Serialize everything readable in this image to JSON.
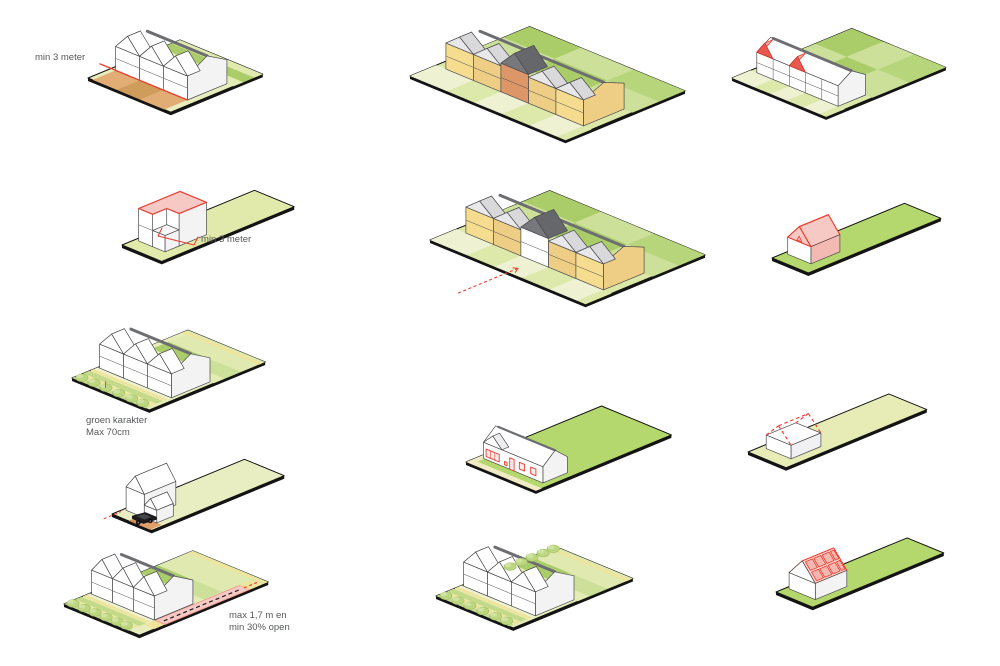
{
  "page": {
    "background": "#ffffff"
  },
  "labels": {
    "min3_top": "min 3 meter",
    "min3_side": "min 3 meter",
    "groen_1": "groen karakter",
    "groen_2": "Max 70cm",
    "max17_1": "max 1,7 m en",
    "max17_2": "min 30% open"
  },
  "colors": {
    "slab": "#141414",
    "line": "#4b4b4d",
    "text": "#57585a",
    "wall": "#ffffff",
    "wallShade": "#f3f3f4",
    "ridge": "#6d6e71",
    "roofDark": "#77787b",
    "roofDarker": "#66676a",
    "plotBase": "#e7edbd",
    "plotPale": "#eef2d2",
    "plotLight": "#dfe9b0",
    "plotBand": "#e3ecb4",
    "plotMid": "#cde09a",
    "plotDark": "#aacd6a",
    "plotGreen": "#b5d86e",
    "pathYellow": "#efe49b",
    "pathPale": "#f0ebc4",
    "hedge": "#bdd680",
    "hedgeLight": "#d0e3a2",
    "hedgeStroke": "#a3c163",
    "orangeLight": "#e2ad74",
    "orangeDark": "#cf9c5c",
    "driveTan": "#dfa069",
    "driveDark": "#d29057",
    "yellowWall": "#f6dc8e",
    "yellowWall2": "#eecd85",
    "orangeWall": "#dd9668",
    "red": "#ee3b2e",
    "redDark": "#c9352b",
    "redFill": "#e8584e",
    "pink": "#f7c9c4",
    "pinkLight": "#fbe4e1",
    "pinkMid": "#f2b0aa",
    "pinkPanel": "#f5b8b1",
    "pinkRoof": "#f9d7d2",
    "pinkWall": "#f3b9b3",
    "windowFill": "#fdeceb",
    "car": "#1d1d1f"
  }
}
